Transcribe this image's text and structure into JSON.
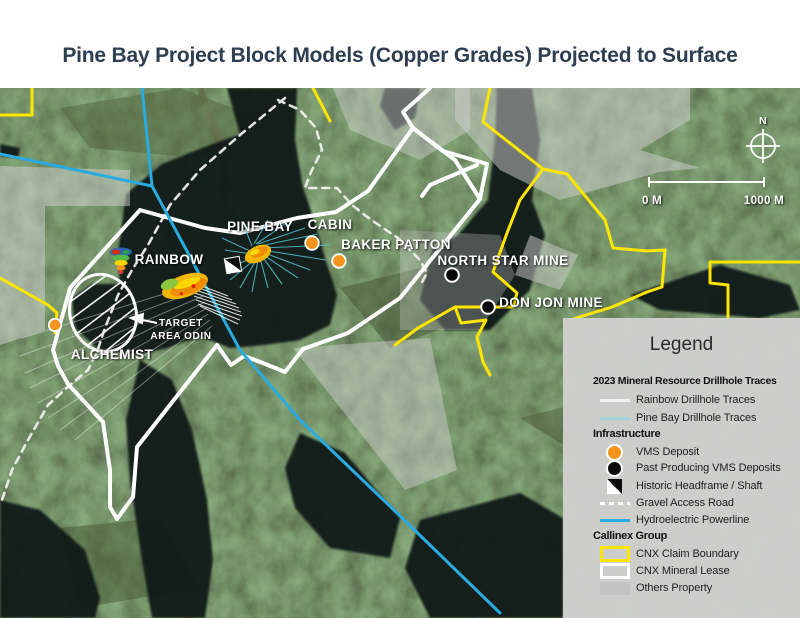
{
  "header": {
    "title": "Pine Bay Project Block Models (Copper Grades) Projected to Surface"
  },
  "map": {
    "labels": {
      "rainbow": "RAINBOW",
      "pine_bay": "PINE BAY",
      "cabin": "CABIN",
      "baker_patton": "BAKER PATTON",
      "north_star": "NORTH STAR MINE",
      "don_jon": "DON JON MINE",
      "alchemist": "ALCHEMIST",
      "target_area_line1": "TARGET",
      "target_area_line2": "AREA ODIN"
    },
    "compass": {
      "north": "N"
    },
    "scale_bar": {
      "start": "0 M",
      "end": "1000 M"
    }
  },
  "legend": {
    "title": "Legend",
    "sections": {
      "drillholes": {
        "heading": "2023 Mineral Resource Drillhole Traces",
        "rainbow_traces": "Rainbow Drillhole Traces",
        "pine_bay_traces": "Pine Bay Drillhole Traces"
      },
      "infrastructure": {
        "heading": "Infrastructure",
        "vms": "VMS Deposit",
        "past_vms": "Past Producing VMS Deposits",
        "headframe": "Historic Headframe / Shaft",
        "gravel": "Gravel Access Road",
        "hydro": "Hydroelectric Powerline"
      },
      "callinex": {
        "heading": "Callinex Group",
        "claim": "CNX Claim Boundary",
        "lease": "CNX Mineral Lease",
        "others": "Others Property"
      }
    }
  },
  "colors": {
    "vms_orange": "#f7941e",
    "powerline_blue": "#29abe2",
    "claim_yellow": "#ffe500",
    "pine_bay_trace_teal": "#9fd6dc",
    "rainbow_trace_white": "#eef2f3",
    "title_navy": "#2d3e50",
    "legend_background": "#d0d0d0"
  }
}
